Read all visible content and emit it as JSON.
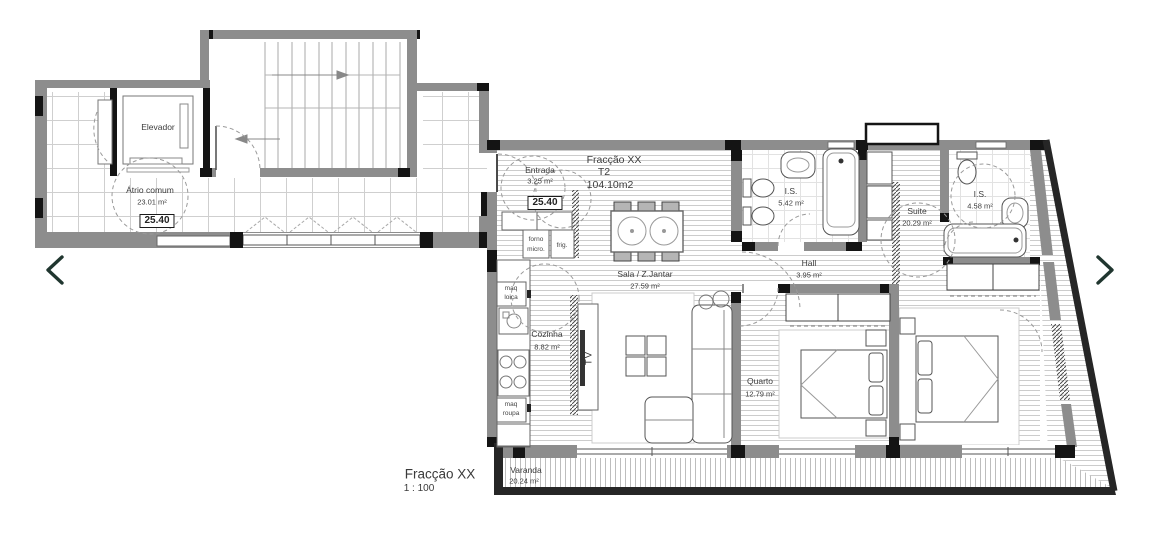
{
  "plan_title": {
    "name": "Fracção XX",
    "scale": "1 : 100"
  },
  "unit": {
    "name": "Fracção XX",
    "type": "T2",
    "total_area": "104.10m2"
  },
  "rooms": {
    "elevador": {
      "name": "Elevador"
    },
    "atrio": {
      "name": "Átrio comum",
      "area": "23.01 m²",
      "level": "25.40"
    },
    "entrada": {
      "name": "Entrada",
      "area": "3.25 m²",
      "level": "25.40"
    },
    "is1": {
      "name": "I.S.",
      "area": "5.42 m²"
    },
    "suite": {
      "name": "Suite",
      "area": "20.29 m²"
    },
    "is2": {
      "name": "I.S.",
      "area": "4.58 m²"
    },
    "hall": {
      "name": "Hall",
      "area": "3.95 m²"
    },
    "sala": {
      "name": "Sala / Z.Jantar",
      "area": "27.59 m²"
    },
    "cozinha": {
      "name": "Cozinha",
      "area": "8.82 m²"
    },
    "quarto": {
      "name": "Quarto",
      "area": "12.79 m²"
    },
    "varanda": {
      "name": "Varanda",
      "area": "20.24 m²"
    }
  },
  "labels": {
    "forno_line1": "forno",
    "forno_line2": "micro.",
    "frig": "frig.",
    "maq_loica_line1": "maq",
    "maq_loica_line2": "loiça",
    "maq_roupa_line1": "maq",
    "maq_roupa_line2": "roupa",
    "tv": "TV"
  },
  "nav": {
    "prev_icon": "chevron-left",
    "next_icon": "chevron-right"
  },
  "colors": {
    "wall_gray": "#8d8d8d",
    "wall_dark": "#262626",
    "wall_black": "#141414",
    "deck_line": "#cccccc",
    "tile_line": "#cfcfcf",
    "nav_chevron": "#20362f"
  }
}
